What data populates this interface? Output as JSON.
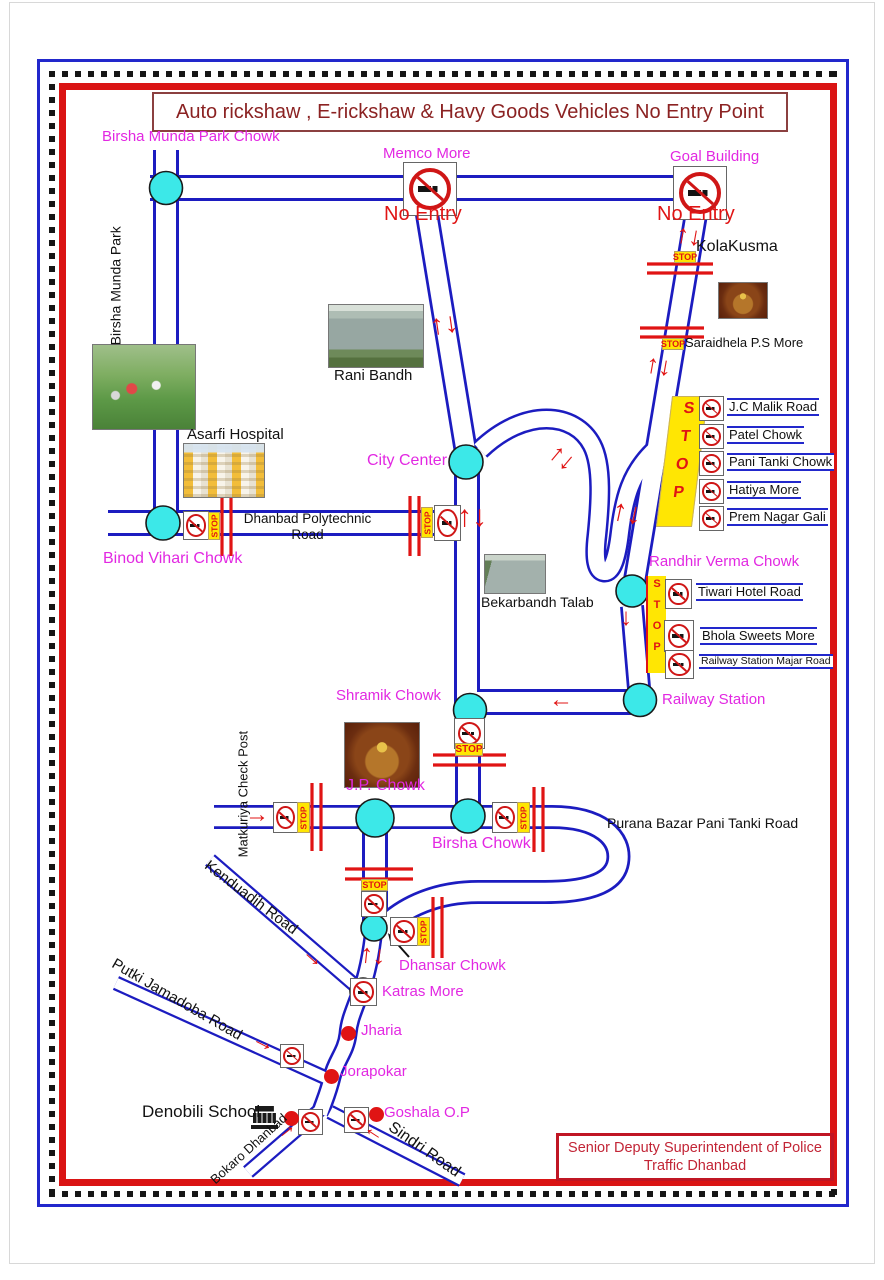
{
  "page": {
    "title": "Auto rickshaw , E-rickshaw & Havy Goods Vehicles No Entry Point",
    "footer": {
      "line1": "Senior Deputy Superintendent of Police",
      "line2": "Traffic Dhanbad"
    }
  },
  "labels": {
    "stop": "STOP",
    "no_entry": "No Entry"
  },
  "icons": {
    "two_way": "↑↓",
    "down": "↓",
    "left": "←",
    "right": "→"
  },
  "places": {
    "birsha_munda_park_chowk": "Birsha Munda Park Chowk",
    "birsha_munda_park": "Birsha Munda Park",
    "memco_more": "Memco More",
    "goal_building": "Goal Building",
    "kolakusma": "KolaKusma",
    "saraidhela": "Saraidhela P.S More",
    "rani_bandh": "Rani Bandh",
    "asarfi_hospital": "Asarfi Hospital",
    "city_center": "City Center",
    "dhanbad_polytechnic_road": "Dhanbad Polytechnic Road",
    "binod_vihari_chowk": "Binod Vihari Chowk",
    "randhir_verma_chowk": "Randhir Verma Chowk",
    "tiwari_hotel_road": "Tiwari Hotel Road",
    "bhola_sweets_more": "Bhola Sweets More",
    "railway_station_majar_road": "Railway Station Majar Road",
    "bekarbandh_talab": "Bekarbandh Talab",
    "shramik_chowk": "Shramik Chowk",
    "railway_station": "Railway Station",
    "jp_chowk": "J.P. Chowk",
    "birsha_chowk": "Birsha Chowk",
    "purana_bazar_pani_tanki_road": "Purana Bazar Pani Tanki Road",
    "matkuriya_check_post": "Matkuriya Check Post",
    "kenduadih_road": "Kenduadih Road",
    "dhansar_chowk": "Dhansar Chowk",
    "katras_more": "Katras More",
    "putki_jamadoba_road": "Putki Jamadoba Road",
    "jharia": "Jharia",
    "jorapokar": "Jorapokar",
    "denobili_school": "Denobili School",
    "goshala_op": "Goshala O.P",
    "bokaro_dhanbad": "Bokaro Dhanbad",
    "sindri_road": "Sindri Road"
  },
  "stop_box": {
    "items": [
      "J.C Malik Road",
      "Patel Chowk",
      "Pani Tanki Chowk",
      "Hatiya More",
      "Prem Nagar Gali"
    ]
  },
  "colors": {
    "road": "#1c1cc0",
    "magenta": "#e228e2",
    "red": "#e01414",
    "yellow": "#ffe603",
    "cyan": "#3ce8e8",
    "maroon": "#8b2222"
  }
}
